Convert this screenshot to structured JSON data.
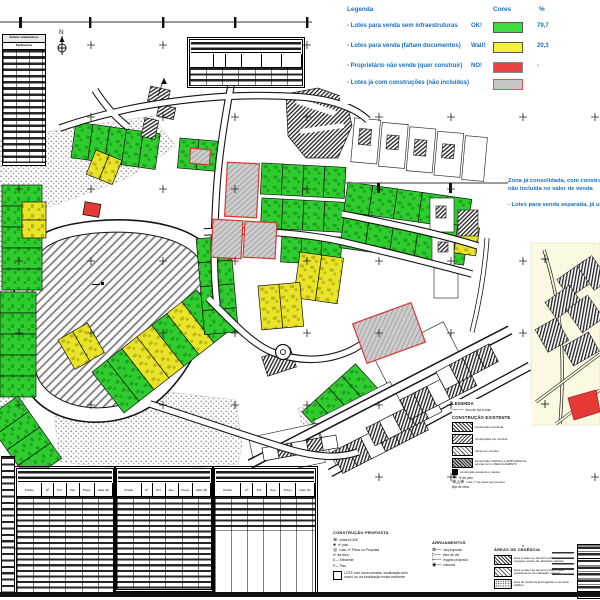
{
  "legend": {
    "title": "Legenda",
    "col_colors": "Cores",
    "col_pct": "%",
    "items": [
      {
        "label": "- Lotes para venda sem infraestruturas",
        "tag": "OK!",
        "pct": "79,7",
        "color": "#3fdc3f",
        "border": "#555555"
      },
      {
        "label": "- Lotes para venda (faltam documentos)",
        "tag": "Wait!",
        "pct": "20,3",
        "color": "#f5ef38",
        "border": "#555555"
      },
      {
        "label": "- Proprietário não vende (quer construir)",
        "tag": "NO!",
        "pct": "-",
        "color": "#ea4343",
        "border": "#888888"
      },
      {
        "label": "- Lotes já com construções (não incluídos)",
        "tag": "",
        "pct": "",
        "color": "#c6c6c6",
        "border": "#e05555"
      }
    ]
  },
  "notes": {
    "line1": "Zona já consolidada, com construções",
    "line2": "não incluída no valor de venda",
    "line3": "- Lotes para venda separada, já urbanizada"
  },
  "params_table": {
    "title": "Índices urbanísticos",
    "col": "Parâmetros"
  },
  "lots_columns": {
    "c0": "Prédio",
    "c1": "Nº",
    "c2": "Pol.",
    "c3": "Sup.",
    "c4": "Preço",
    "c5": "Valor (€)"
  },
  "proposta": {
    "title": "CONSTRUÇÃO PROPOSTA",
    "items": [
      "cotas ACA/E",
      "nº piso",
      "cota, nº Pisos ou Proposta"
    ],
    "obra": [
      "nº da obra",
      "E—  Existente",
      "P—  Piso"
    ],
    "lote_note": "LOTE com nova moradia, localização sem coord. ou na localização exata conforme"
  },
  "arruamentos": {
    "title": "ARRUAMENTOS",
    "items": [
      "via proposta",
      "eixo de via",
      "esgoto proposto",
      "rotunda"
    ]
  },
  "cedencia": {
    "title": "ÁREAS DE CEDÊNCIA",
    "items": [
      "área a ceder ao domínio público para espaços verdes de utilização coletiva",
      "área a ceder ao domínio público para equipamento de utilização coletiva",
      "área de cedência já integrada no domínio público"
    ]
  },
  "inset_legend": {
    "title": "LEGENDA",
    "axis_item": "eixo de via a criar",
    "existente_title": "CONSTRUÇÃO EXISTENTE",
    "items": [
      "construção concluída",
      "construções por concluir",
      "obras por concluir",
      "construção CADUCA e APROVADA de acordo com o REGULAMENTO",
      "construção existente a manter"
    ],
    "extra": [
      "nº de piso",
      "cota, nº de pisos (já previsto)",
      "tipo de obra"
    ]
  },
  "compass": "N"
}
